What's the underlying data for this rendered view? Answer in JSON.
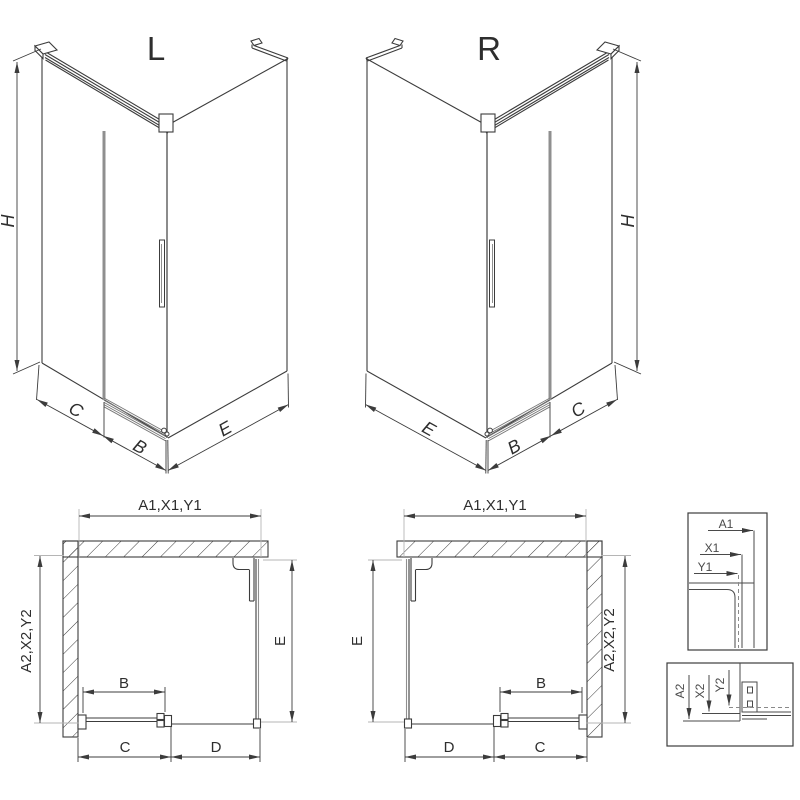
{
  "iso_left": {
    "title": "L",
    "dim_h": "H",
    "dim_c": "C",
    "dim_b": "B",
    "dim_e": "E"
  },
  "iso_right": {
    "title": "R",
    "dim_h": "H",
    "dim_c": "C",
    "dim_b": "B",
    "dim_e": "E"
  },
  "plan_left": {
    "dim_width": "A1,X1,Y1",
    "dim_depth": "A2,X2,Y2",
    "dim_b": "B",
    "dim_c": "C",
    "dim_d": "D",
    "dim_e": "E"
  },
  "plan_right": {
    "dim_width": "A1,X1,Y1",
    "dim_depth": "A2,X2,Y2",
    "dim_b": "B",
    "dim_c": "C",
    "dim_d": "D",
    "dim_e": "E"
  },
  "detail_top": {
    "dim_a1": "A1",
    "dim_x1": "X1",
    "dim_y1": "Y1"
  },
  "detail_bottom": {
    "dim_a2": "A2",
    "dim_x2": "X2",
    "dim_y2": "Y2"
  },
  "colors": {
    "line": "#3c3c3c",
    "light_line": "#b5b5b5",
    "glass": "#8f8f8f",
    "background": "#ffffff"
  }
}
